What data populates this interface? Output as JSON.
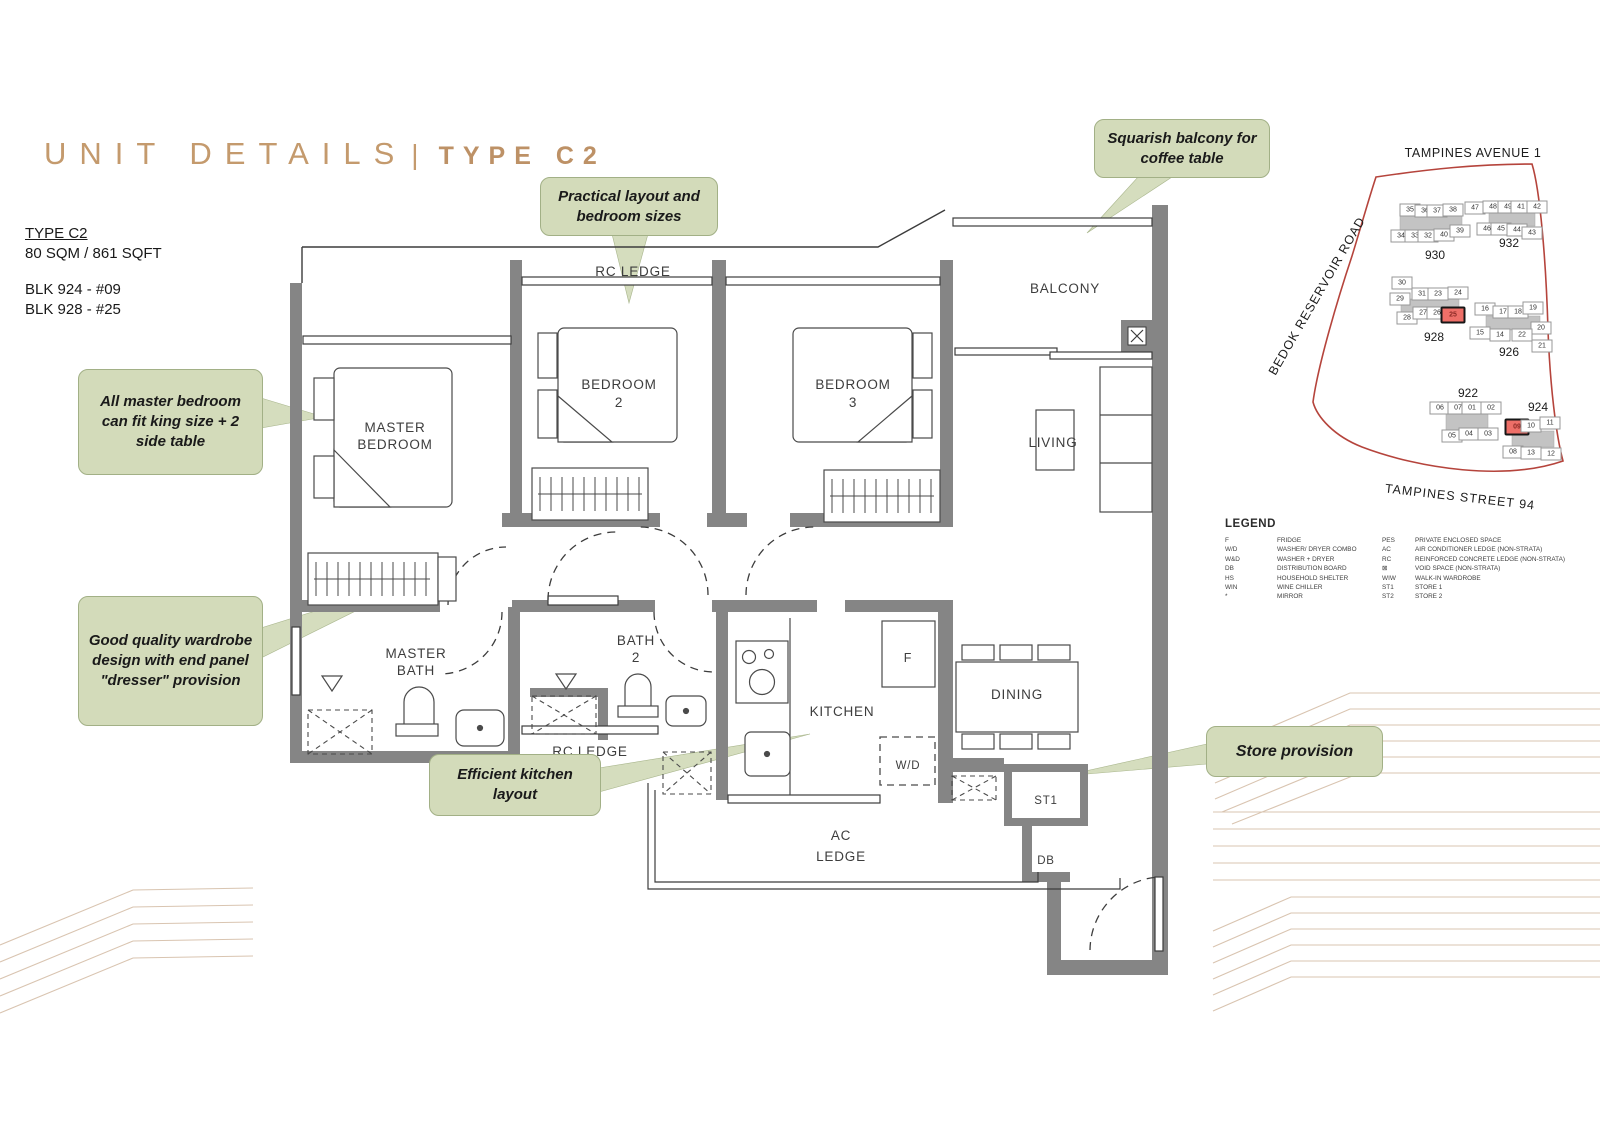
{
  "title": {
    "left": "UNIT DETAILS",
    "divider": "|",
    "right": "TYPE C2"
  },
  "info": {
    "type_label": "TYPE C2",
    "area": "80 SQM / 861 SQFT",
    "block_1": "BLK 924 - #09",
    "block_2": "BLK 928 - #25"
  },
  "callouts": [
    {
      "key": "practical",
      "text": "Practical layout and bedroom sizes"
    },
    {
      "key": "balcony",
      "text": "Squarish balcony for coffee table"
    },
    {
      "key": "master",
      "text": "All master bedroom can fit king size + 2 side table"
    },
    {
      "key": "wardrobe",
      "text": "Good quality wardrobe design with end panel \"dresser\" provision"
    },
    {
      "key": "kitchen",
      "text": "Efficient kitchen layout"
    },
    {
      "key": "store",
      "text": "Store provision"
    }
  ],
  "plan_labels": {
    "rc_ledge_top": "RC LEDGE",
    "rc_ledge_mid": "RC LEDGE",
    "master_bedroom_1": "MASTER",
    "master_bedroom_2": "BEDROOM",
    "bedroom2_1": "BEDROOM",
    "bedroom2_2": "2",
    "bedroom3_1": "BEDROOM",
    "bedroom3_2": "3",
    "balcony": "BALCONY",
    "living": "LIVING",
    "master_bath_1": "MASTER",
    "master_bath_2": "BATH",
    "bath2_1": "BATH",
    "bath2_2": "2",
    "kitchen": "KITCHEN",
    "dining": "DINING",
    "fridge": "F",
    "washer": "W/D",
    "store1": "ST1",
    "db": "DB",
    "ac_ledge_1": "AC",
    "ac_ledge_2": "LEDGE"
  },
  "sitemap": {
    "road_top": "TAMPINES AVENUE 1",
    "road_left": "BEDOK RESERVOIR ROAD",
    "road_bottom": "TAMPINES STREET 94",
    "highlight_color": "#ee6f68",
    "blocks": [
      {
        "name": "930",
        "lx": 1435,
        "ly": 255,
        "units": [
          {
            "n": "35",
            "x": 1410,
            "y": 210
          },
          {
            "n": "36",
            "x": 1425,
            "y": 211
          },
          {
            "n": "37",
            "x": 1437,
            "y": 211
          },
          {
            "n": "38",
            "x": 1453,
            "y": 210
          },
          {
            "n": "47",
            "x": 1475,
            "y": 208
          },
          {
            "n": "34",
            "x": 1401,
            "y": 236
          },
          {
            "n": "33",
            "x": 1415,
            "y": 236
          },
          {
            "n": "32",
            "x": 1428,
            "y": 236
          },
          {
            "n": "40",
            "x": 1444,
            "y": 235
          },
          {
            "n": "39",
            "x": 1460,
            "y": 231
          }
        ]
      },
      {
        "name": "932",
        "lx": 1509,
        "ly": 243,
        "units": [
          {
            "n": "48",
            "x": 1493,
            "y": 207
          },
          {
            "n": "49",
            "x": 1508,
            "y": 207
          },
          {
            "n": "41",
            "x": 1521,
            "y": 207
          },
          {
            "n": "42",
            "x": 1537,
            "y": 207
          },
          {
            "n": "46",
            "x": 1487,
            "y": 229
          },
          {
            "n": "45",
            "x": 1501,
            "y": 229
          },
          {
            "n": "44",
            "x": 1517,
            "y": 230
          },
          {
            "n": "43",
            "x": 1532,
            "y": 233
          }
        ]
      },
      {
        "name": "928",
        "lx": 1434,
        "ly": 337,
        "units": [
          {
            "n": "30",
            "x": 1402,
            "y": 283
          },
          {
            "n": "29",
            "x": 1400,
            "y": 299
          },
          {
            "n": "31",
            "x": 1422,
            "y": 294
          },
          {
            "n": "23",
            "x": 1438,
            "y": 294
          },
          {
            "n": "24",
            "x": 1458,
            "y": 293
          },
          {
            "n": "28",
            "x": 1407,
            "y": 318
          },
          {
            "n": "27",
            "x": 1423,
            "y": 313
          },
          {
            "n": "26",
            "x": 1437,
            "y": 313
          },
          {
            "n": "25",
            "x": 1453,
            "y": 315,
            "hot": true
          }
        ]
      },
      {
        "name": "926",
        "lx": 1509,
        "ly": 352,
        "units": [
          {
            "n": "16",
            "x": 1485,
            "y": 309
          },
          {
            "n": "17",
            "x": 1503,
            "y": 312
          },
          {
            "n": "18",
            "x": 1518,
            "y": 312
          },
          {
            "n": "19",
            "x": 1533,
            "y": 308
          },
          {
            "n": "20",
            "x": 1541,
            "y": 328
          },
          {
            "n": "15",
            "x": 1480,
            "y": 333
          },
          {
            "n": "14",
            "x": 1500,
            "y": 335
          },
          {
            "n": "22",
            "x": 1522,
            "y": 335
          },
          {
            "n": "21",
            "x": 1542,
            "y": 346
          }
        ]
      },
      {
        "name": "922",
        "lx": 1468,
        "ly": 393,
        "units": [
          {
            "n": "06",
            "x": 1440,
            "y": 408
          },
          {
            "n": "07",
            "x": 1458,
            "y": 408
          },
          {
            "n": "01",
            "x": 1472,
            "y": 408
          },
          {
            "n": "02",
            "x": 1491,
            "y": 408
          },
          {
            "n": "05",
            "x": 1452,
            "y": 436
          },
          {
            "n": "04",
            "x": 1469,
            "y": 434
          },
          {
            "n": "03",
            "x": 1488,
            "y": 434
          }
        ]
      },
      {
        "name": "924",
        "lx": 1538,
        "ly": 407,
        "units": [
          {
            "n": "09",
            "x": 1517,
            "y": 427,
            "hot": true
          },
          {
            "n": "10",
            "x": 1531,
            "y": 426
          },
          {
            "n": "11",
            "x": 1550,
            "y": 423
          },
          {
            "n": "08",
            "x": 1513,
            "y": 452
          },
          {
            "n": "13",
            "x": 1531,
            "y": 453
          },
          {
            "n": "12",
            "x": 1551,
            "y": 454
          }
        ]
      }
    ]
  },
  "legend": {
    "title": "LEGEND",
    "left": [
      [
        "F",
        "FRIDGE"
      ],
      [
        "W/D",
        "WASHER/ DRYER COMBO"
      ],
      [
        "W&D",
        "WASHER + DRYER"
      ],
      [
        "DB",
        "DISTRIBUTION BOARD"
      ],
      [
        "HS",
        "HOUSEHOLD SHELTER"
      ],
      [
        "WIN",
        "WINE CHILLER"
      ],
      [
        "*",
        "MIRROR"
      ]
    ],
    "right": [
      [
        "PES",
        "PRIVATE ENCLOSED SPACE"
      ],
      [
        "AC",
        "AIR CONDITIONER LEDGE (NON-STRATA)"
      ],
      [
        "RC",
        "REINFORCED CONCRETE LEDGE (NON-STRATA)"
      ],
      [
        "⊠",
        "VOID SPACE (NON-STRATA)"
      ],
      [
        "WIW",
        "WALK-IN WARDROBE"
      ],
      [
        "ST1",
        "STORE 1"
      ],
      [
        "ST2",
        "STORE 2"
      ]
    ]
  }
}
